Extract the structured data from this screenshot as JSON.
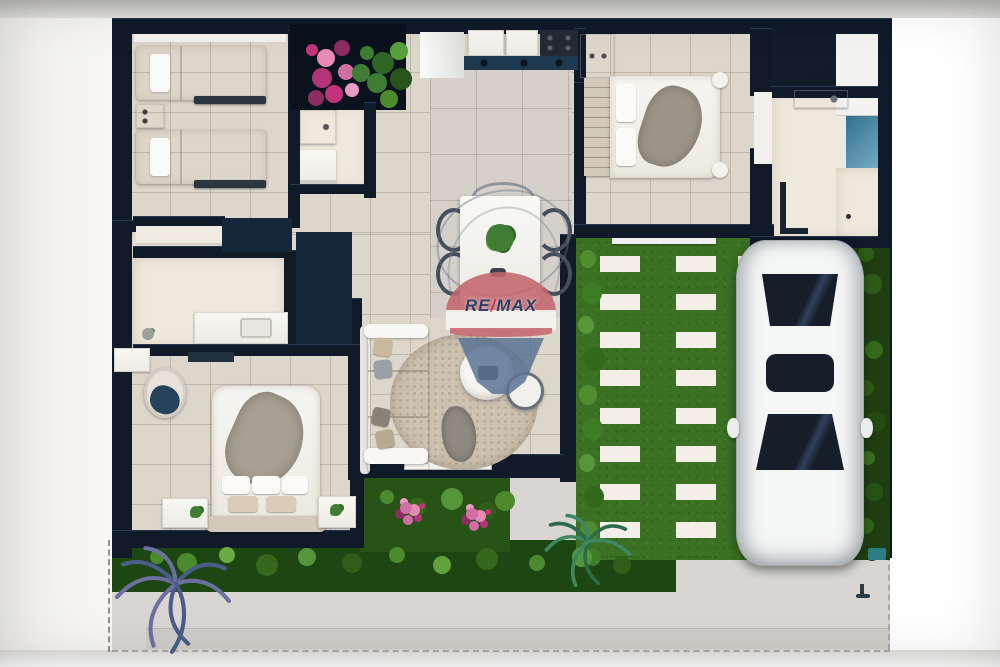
{
  "watermark": {
    "text": "RE/MAX",
    "re": "RE",
    "slash": "/",
    "max": "MAX"
  },
  "palette": {
    "wall": "#101a28",
    "navy": "#1c394f",
    "tile": "#ddd6cb",
    "dining_tile": "#d5d0ca",
    "cream": "#efe9dd",
    "white": "#f5f4f0",
    "grass": "#3a7122",
    "hedge": "#24490f",
    "garden": "#1d4712",
    "paver": "#f3efe8",
    "patio": "#d8d5d2",
    "slab": "#cfccc8",
    "flower_pink": "#c2347a",
    "plant_green": "#3e7d33",
    "wood": "#d3c9ba",
    "car_body": "#f4f5f5",
    "car_glass": "#161e2a",
    "teal": "#2e7d85",
    "remax_red": "#c4666e",
    "remax_blue": "#5b7394",
    "remax_text": "#2c3f66",
    "remax_slash": "#c0394a",
    "palm_purple": "#6c6fa0",
    "palm_green": "#3f8663",
    "throw_gray": "#8f8a80",
    "navy_throw": "#27435c"
  },
  "scene": {
    "description": "3D top-down architectural floor plan render of a single-storey house with driveway and RE/MAX watermark",
    "rooms": [
      "twin-bedroom",
      "bathroom",
      "kitchen",
      "dining-area",
      "double-bedroom",
      "ensuite-bathroom",
      "walk-in-closet",
      "second-bathroom",
      "master-bedroom",
      "living-room",
      "driveway-carport",
      "front-garden",
      "patio"
    ],
    "furniture": [
      "twin-bed",
      "twin-bed",
      "nightstand",
      "double-bed",
      "wardrobe",
      "dresser",
      "dining-table",
      "dining-chairs",
      "sofa",
      "area-rug",
      "coffee-table",
      "side-table",
      "armchair",
      "master-bed",
      "nightstands",
      "bathroom-vanity",
      "kitchen-counter",
      "cooktop",
      "fridge",
      "shower",
      "sinks",
      "toilet"
    ],
    "vehicles": [
      "white-sedan"
    ],
    "landscaping": [
      "flower-planter",
      "lawn-with-paver-strips",
      "side-hedge",
      "garden-shrubs",
      "palm-plants"
    ]
  }
}
